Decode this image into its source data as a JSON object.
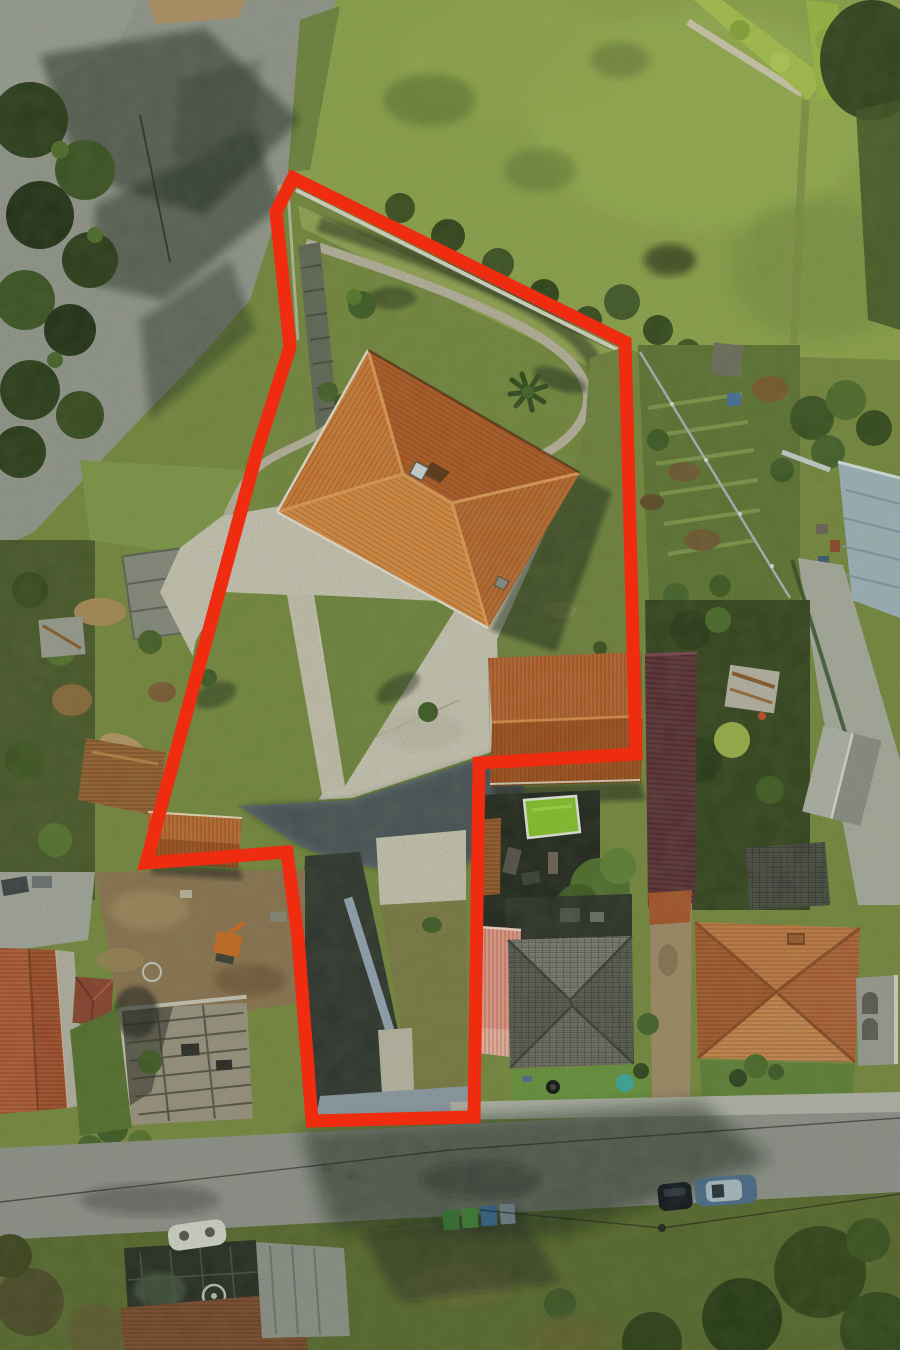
{
  "image": {
    "kind": "aerial drone photograph",
    "view": "top-down orthographic",
    "scene": "residential land parcel with a large terracotta hip-roof house, lawns, driveway and neighbouring houses; parcel outlined with a thick red boundary overlay",
    "lighting": "low afternoon sun, long shadows cast toward the north-east",
    "width_px": 900,
    "height_px": 1350
  },
  "annotation": {
    "name": "property-boundary-outline",
    "shape": "closed polygon",
    "color": "#ef2b10",
    "stroke_px": 13,
    "points": "293,178 625,342 636,754 479,763 474,1117 312,1121 298,938 287,852 146,863 258,448 290,347 276,212"
  },
  "palette": {
    "boundary_red": "#ef2b10",
    "main_roof_terracotta": "#c06f33",
    "roof_bright_face": "#d88a42",
    "roof_dark_face": "#a8552a",
    "patio_concrete": "#c9c5b6",
    "sunlit_grass": "#8da34c",
    "shaded_grass": "#3f5227",
    "asphalt_road": "#90938e",
    "driveway_shadow_blue": "#5e6e80",
    "pool_green": "#86c32d",
    "salmon_metal_roof": "#e89a8a",
    "rust_roof": "#9a6232",
    "maroon_pergola": "#5e3038",
    "warehouse_roof_blue_gray": "#9fb3bd"
  },
  "scene_objects": [
    {
      "name": "main-house-hip-roof",
      "color": "#c06f33",
      "bbox": [
        277,
        350,
        580,
        628
      ],
      "note": "diamond-oriented hip roof with ridge skylight and small vent"
    },
    {
      "name": "rooftop-skylight",
      "color": "#cfd8d8",
      "bbox": [
        412,
        464,
        432,
        482
      ]
    },
    {
      "name": "concrete-patio",
      "color": "#c9c5b6",
      "bbox": [
        155,
        498,
        520,
        805
      ]
    },
    {
      "name": "upper-lawn-terrace",
      "color": "#8a9b52",
      "bbox": [
        290,
        190,
        630,
        470
      ]
    },
    {
      "name": "curved-retaining-wall-path",
      "color": "#b7b1a0",
      "bbox": [
        300,
        240,
        592,
        470
      ]
    },
    {
      "name": "garden-steps",
      "color": "#63675a",
      "bbox": [
        296,
        242,
        338,
        430
      ]
    },
    {
      "name": "palm-tree",
      "color": "#2f4a1e",
      "bbox": [
        510,
        372,
        548,
        412
      ]
    },
    {
      "name": "lawn-tree",
      "color": "#3f5c26",
      "bbox": [
        348,
        290,
        378,
        322
      ]
    },
    {
      "name": "walkway",
      "color": "#c5c1b0",
      "bbox": [
        287,
        595,
        345,
        792
      ]
    },
    {
      "name": "driveway-shadowed",
      "color": "#5e6e80",
      "bbox": [
        235,
        745,
        525,
        870
      ]
    },
    {
      "name": "rear-driveway-corridor",
      "color": "#2e3430",
      "bbox": [
        300,
        850,
        470,
        1117
      ]
    },
    {
      "name": "corridor-retaining-wall",
      "color": "#93a3b6",
      "bbox": [
        343,
        895,
        412,
        1097
      ]
    },
    {
      "name": "gate-apron",
      "color": "#8d9aa8",
      "bbox": [
        316,
        1086,
        470,
        1118
      ]
    },
    {
      "name": "sw-outbuilding-orange-roof",
      "color": "#b3622d",
      "bbox": [
        144,
        812,
        242,
        868
      ]
    },
    {
      "name": "se-outbuilding-orange-roof",
      "color": "#b25a28",
      "bbox": [
        488,
        655,
        640,
        782
      ]
    },
    {
      "name": "nw-road-junction",
      "color": "#90938e",
      "bbox": [
        0,
        0,
        336,
        548
      ]
    },
    {
      "name": "south-road",
      "color": "#8f918d",
      "bbox": [
        0,
        1094,
        900,
        1250
      ]
    },
    {
      "name": "sidewalk-south",
      "color": "#b3b4ac",
      "bbox": [
        450,
        1094,
        900,
        1120
      ]
    },
    {
      "name": "parked-car-dark",
      "color": "#10151d",
      "bbox": [
        658,
        1181,
        692,
        1212
      ]
    },
    {
      "name": "parked-car-blue",
      "color": "#7291ab",
      "bbox": [
        695,
        1176,
        757,
        1206
      ]
    },
    {
      "name": "waste-bins",
      "color": "#2e6b2e",
      "bbox": [
        443,
        1205,
        517,
        1234
      ]
    },
    {
      "name": "neighbor-house-gray-shingle",
      "color": "#5a5c55",
      "bbox": [
        508,
        936,
        632,
        1068
      ]
    },
    {
      "name": "salmon-metal-annex-roof",
      "color": "#e89a8a",
      "bbox": [
        478,
        926,
        521,
        1058
      ]
    },
    {
      "name": "neighbor-house-se-orange-roof",
      "color": "#bf7340",
      "bbox": [
        695,
        922,
        860,
        1062
      ]
    },
    {
      "name": "arched-veranda",
      "color": "#9a9c94",
      "bbox": [
        856,
        978,
        898,
        1062
      ]
    },
    {
      "name": "swimming-pool",
      "color": "#86c32d",
      "bbox": [
        524,
        796,
        580,
        838
      ]
    },
    {
      "name": "kiddie-pool",
      "color": "#3aa7a0",
      "bbox": [
        616,
        1074,
        634,
        1092
      ]
    },
    {
      "name": "spare-tire",
      "color": "#111111",
      "bbox": [
        547,
        1081,
        559,
        1093
      ]
    },
    {
      "name": "maroon-pergola-roof",
      "color": "#5e3038",
      "bbox": [
        645,
        653,
        695,
        905
      ]
    },
    {
      "name": "vegetable-garden-rows",
      "color": "#5e7434",
      "bbox": [
        635,
        345,
        800,
        620
      ]
    },
    {
      "name": "garden-shed",
      "color": "#6b6f5f",
      "bbox": [
        712,
        344,
        742,
        376
      ]
    },
    {
      "name": "warehouse-blue-gray-roof",
      "color": "#9fb3bd",
      "bbox": [
        838,
        462,
        900,
        618
      ]
    },
    {
      "name": "galvanized-fence",
      "color": "#aab4b8",
      "bbox": [
        638,
        350,
        792,
        600
      ]
    },
    {
      "name": "ne-meadow",
      "color": "#8da34c",
      "bbox": [
        287,
        0,
        900,
        360
      ]
    },
    {
      "name": "trimmed-hedges",
      "color": "#a7c14e",
      "bbox": [
        688,
        0,
        842,
        102
      ]
    },
    {
      "name": "construction-house-shell",
      "color": "#9a9281",
      "bbox": [
        118,
        1000,
        252,
        1128
      ]
    },
    {
      "name": "excavator",
      "color": "#c96a20",
      "bbox": [
        214,
        933,
        240,
        964
      ]
    },
    {
      "name": "dirt-yard",
      "color": "#8b7352",
      "bbox": [
        95,
        872,
        305,
        1010
      ]
    },
    {
      "name": "white-paint-circle",
      "color": "#d6d6cc",
      "bbox": [
        142,
        962,
        162,
        982
      ]
    },
    {
      "name": "west-house-red-tile-roof",
      "color": "#a84f2e",
      "bbox": [
        0,
        948,
        68,
        1112
      ]
    },
    {
      "name": "small-hip-roof",
      "color": "#8a4130",
      "bbox": [
        72,
        976,
        112,
        1026
      ]
    },
    {
      "name": "woodpiles-and-sheds",
      "color": "#a98a58",
      "bbox": [
        40,
        560,
        200,
        820
      ]
    },
    {
      "name": "glass-atrium-roof",
      "color": "#262b24",
      "bbox": [
        124,
        1240,
        262,
        1346
      ]
    },
    {
      "name": "spiral-staircase",
      "color": "#b9bdb4",
      "bbox": [
        203,
        1285,
        225,
        1307
      ]
    },
    {
      "name": "brown-tile-roof-sw",
      "color": "#7c4a30",
      "bbox": [
        120,
        1292,
        308,
        1350
      ]
    },
    {
      "name": "gray-panel-roof-sw",
      "color": "#8d908a",
      "bbox": [
        256,
        1240,
        350,
        1338
      ]
    },
    {
      "name": "white-rooftop-chimney",
      "color": "#d2d5cd",
      "bbox": [
        166,
        1218,
        230,
        1250
      ]
    },
    {
      "name": "tree-canopies-south",
      "color": "#2f4319",
      "bbox": [
        600,
        1240,
        900,
        1350
      ]
    },
    {
      "name": "manhole-oil-stains",
      "color": "#4e4e46",
      "bbox": [
        318,
        1160,
        360,
        1184
      ]
    },
    {
      "name": "overhead-wires",
      "color": "#1a1d1a",
      "bbox": [
        0,
        1118,
        900,
        1232
      ]
    }
  ]
}
